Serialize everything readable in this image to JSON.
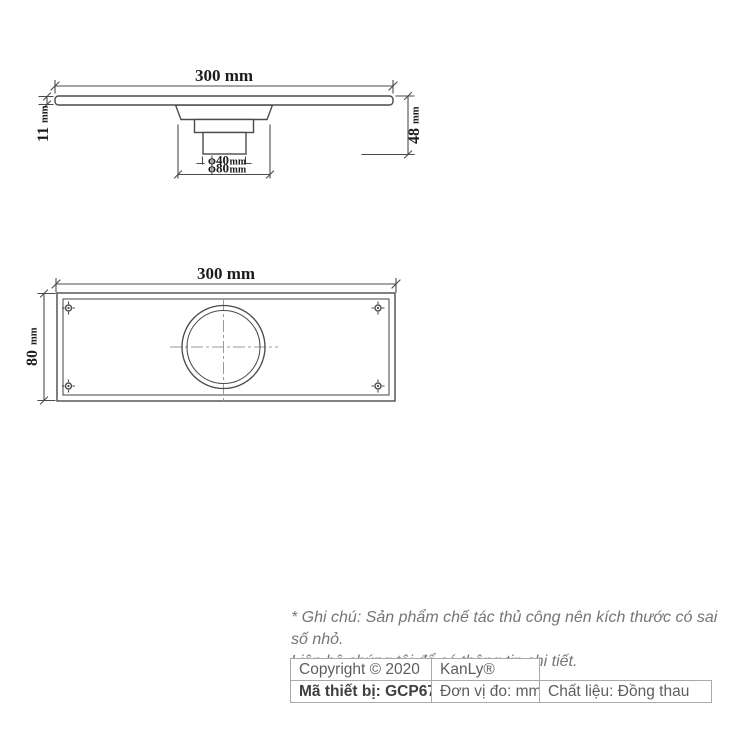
{
  "meta": {
    "background_color": "#ffffff",
    "drawing_line_color": "#4b4b4b",
    "centerline_color": "#9a9a9a",
    "dimension_text_color": "#1c1c1c",
    "note_text_color": "#757575",
    "table_border_color": "#a9a9a9",
    "table_text_color": "#5e5e5e"
  },
  "side_view": {
    "width_label": "300 mm",
    "height_dim": {
      "value": "11",
      "unit": "mm"
    },
    "depth_dim": {
      "value": "48",
      "unit": "mm"
    },
    "small_diameter": {
      "value": "ϕ40",
      "unit": "mm"
    },
    "large_diameter": {
      "value": "ϕ80",
      "unit": "mm"
    }
  },
  "plan_view": {
    "width_label": "300 mm",
    "height_dim": {
      "value": "80",
      "unit": "mm"
    }
  },
  "note": {
    "line1": "* Ghi chú: Sản phẩm chế tác thủ công nên kích thước có sai số nhỏ.",
    "line2": "Liên hệ chúng tôi để có thông tin chi tiết."
  },
  "footer_table": {
    "rows": [
      {
        "cells": [
          "Copyright © 2020",
          "KanLy®"
        ]
      },
      {
        "cells": [
          "Mã thiết bị: GCP67",
          "Đơn vị đo: mm",
          "Chất liệu: Đồng thau"
        ]
      }
    ]
  }
}
